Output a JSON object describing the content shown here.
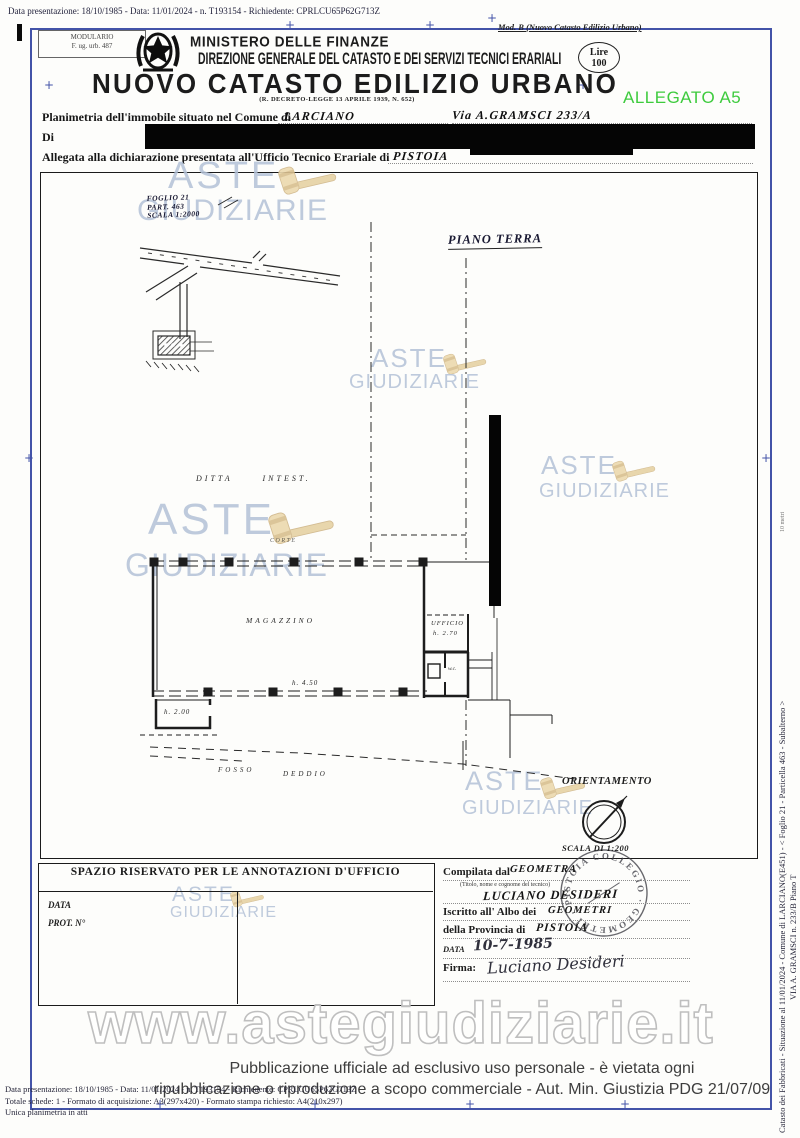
{
  "page": {
    "top_meta": "Data presentazione: 18/10/1985 - Data: 11/01/2024 - n. T193154 - Richiedente: CPRLCU65P62G713Z",
    "mod_label": "Mod. B (Nuovo Catasto Edilizio Urbano)",
    "modulario_line1": "MODULARIO",
    "modulario_line2": "F. ug. urb. 487",
    "allegato": "ALLEGATO A5"
  },
  "header": {
    "ministry": "MINISTERO DELLE FINANZE",
    "direction": "DIREZIONE GENERALE DEL CATASTO E DEI SERVIZI TECNICI ERARIALI",
    "title": "NUOVO CATASTO EDILIZIO URBANO",
    "subtitle": "(R. DECRETO-LEGGE 13 APRILE 1939, N. 652)",
    "stamp_line1": "Lire",
    "stamp_line2": "100"
  },
  "form": {
    "line1_label": "Planimetria dell'immobile situato nel Comune di",
    "line1_value": "LARCIANO",
    "line1_via": "Via A.GRAMSCI 233/A",
    "line2_label": "Di",
    "line3_label": "Allegata alla dichiarazione presentata all'Ufficio Tecnico Erariale di",
    "line3_value": "PISTOIA"
  },
  "plan": {
    "sheet_note_line1": "FOGLIO 21",
    "sheet_note_line2": "PART. 463",
    "sheet_note_line3": "SCALA 1:2000",
    "floor_label": "PIANO TERRA",
    "ditta_label": "DITTA      INTEST.",
    "corte_label": "CORTE",
    "room_main": "MAGAZZINO",
    "room_main_height": "h. 4.50",
    "room_small_height": "h. 2.00",
    "room_office": "UFFICIO",
    "room_office_height": "h. 2.70",
    "room_wc": "w.c.",
    "fosso_label_1": "FOSSO",
    "fosso_label_2": "DEDDIO",
    "orientation_label": "ORIENTAMENTO",
    "scale_label": "SCALA DI 1:200"
  },
  "annotations": {
    "box_title": "SPAZIO RISERVATO PER LE ANNOTAZIONI D'UFFICIO",
    "data_label": "DATA",
    "prot_label": "PROT. N°",
    "compiled_label": "Compilata dal",
    "compiled_value": "GEOMETRA",
    "tech_hint": "(Titolo, nome e cognome del tecnico)",
    "tech_name": "LUCIANO DESIDERI",
    "albo_label": "Iscritto all' Albo dei",
    "albo_value": "GEOMETRI",
    "province_label": "della Provincia di",
    "province_value": "PISTOIA",
    "date_label": "DATA",
    "date_value": "10-7-1985",
    "sign_label": "Firma:",
    "signature_value": "Luciano Desideri",
    "stamp_text": "COLLEGIO · GEOMETRI · PISTOIA ·"
  },
  "watermark": {
    "line1": "ASTE",
    "line2": "GIUDIZIARIE",
    "url": "www.astegiudiziarie.it",
    "color": "#b4c2d7"
  },
  "footer": {
    "disclaimer_line1": "Pubblicazione ufficiale ad esclusivo uso personale - è vietata ogni",
    "disclaimer_line2": "ripubblicazione o riproduzione a scopo commerciale - Aut. Min. Giustizia PDG 21/07/09",
    "meta_line1": "Data presentazione: 18/10/1985 - Data: 11/01/2024 - n. T193154 - Richiedente: CPRLCU65P62G713Z",
    "meta_line2": "Totale schede: 1 - Formato di acquisizione: A3(297x420) - Formato stampa richiesto: A4(210x297)",
    "meta_line3": "Unica planimetria in atti",
    "side_line1": "Catasto dei Fabbricati - Situazione al 11/01/2024 - Comune di LARCIANO(E451) - < Foglio 21 - Particella 463 - Subalterno >",
    "side_line2": "VIA A. GRAMSCI n. 233/B Piano T",
    "edge_code": "10 metri"
  }
}
